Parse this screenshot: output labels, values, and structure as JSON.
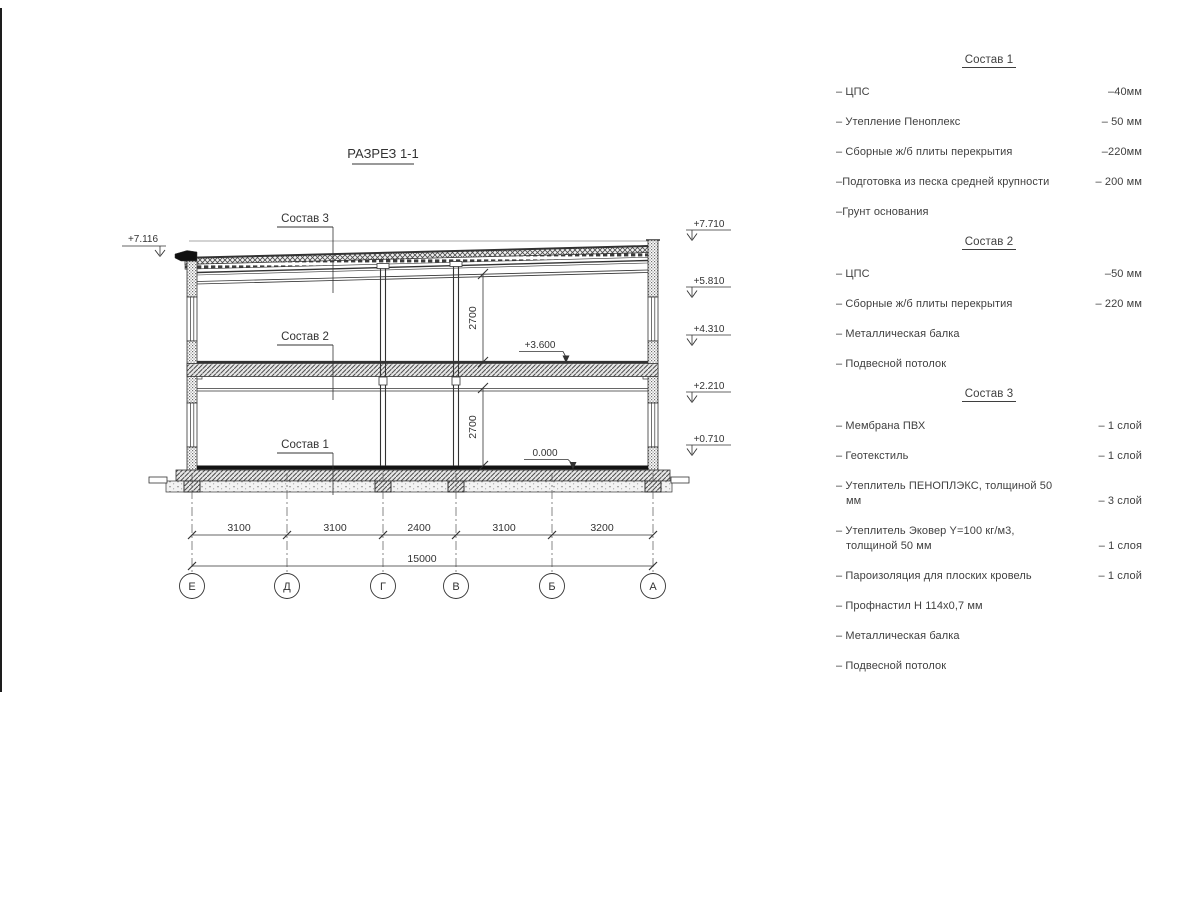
{
  "drawing": {
    "title": "РАЗРЕЗ 1-1",
    "labels": {
      "sostav3": "Состав 3",
      "sostav2": "Состав 2",
      "sostav1": "Состав 1"
    },
    "elev": {
      "left": "+7.116",
      "right": [
        "+7.710",
        "+5.810",
        "+4.310",
        "+2.210",
        "+0.710"
      ],
      "floor2": "+3.600",
      "floor1": "0.000"
    },
    "heights": [
      "2700",
      "2700"
    ],
    "dims": {
      "segments": [
        "3100",
        "3100",
        "2400",
        "3100",
        "3200"
      ],
      "total": "15000"
    },
    "axes": [
      "Е",
      "Д",
      "Г",
      "В",
      "Б",
      "А"
    ]
  },
  "legend": {
    "groups": [
      {
        "title": "Состав 1",
        "items": [
          {
            "name": "– ЦПС",
            "value": "–40мм"
          },
          {
            "name": "– Утепление Пеноплекс",
            "value": "– 50 мм"
          },
          {
            "name": "– Сборные ж/б плиты перекрытия",
            "value": "–220мм"
          },
          {
            "name": "–Подготовка из песка средней крупности",
            "value": "– 200 мм"
          },
          {
            "name": "–Грунт основания",
            "value": ""
          }
        ]
      },
      {
        "title": "Состав 2",
        "items": [
          {
            "name": "– ЦПС",
            "value": "–50 мм"
          },
          {
            "name": "– Сборные ж/б плиты перекрытия",
            "value": "– 220 мм"
          },
          {
            "name": "– Металлическая балка",
            "value": ""
          },
          {
            "name": "– Подвесной потолок",
            "value": ""
          }
        ]
      },
      {
        "title": "Состав 3",
        "items": [
          {
            "name": "– Мембрана ПВХ",
            "value": "– 1 слой"
          },
          {
            "name": "– Геотекстиль",
            "value": "– 1 слой"
          },
          {
            "name": "– Утеплитель ПЕНОПЛЭКС, толщиной 50 мм",
            "value": "– 3 слой"
          },
          {
            "name": "– Утеплитель Эковер Y=100 кг/м3, толщиной 50 мм",
            "value": "– 1 слоя"
          },
          {
            "name": "– Пароизоляция для плоских кровель",
            "value": "– 1 слой"
          },
          {
            "name": "– Профнастил Н 114х0,7 мм",
            "value": ""
          },
          {
            "name": "– Металлическая балка",
            "value": ""
          },
          {
            "name": "– Подвесной потолок",
            "value": ""
          }
        ]
      }
    ]
  }
}
